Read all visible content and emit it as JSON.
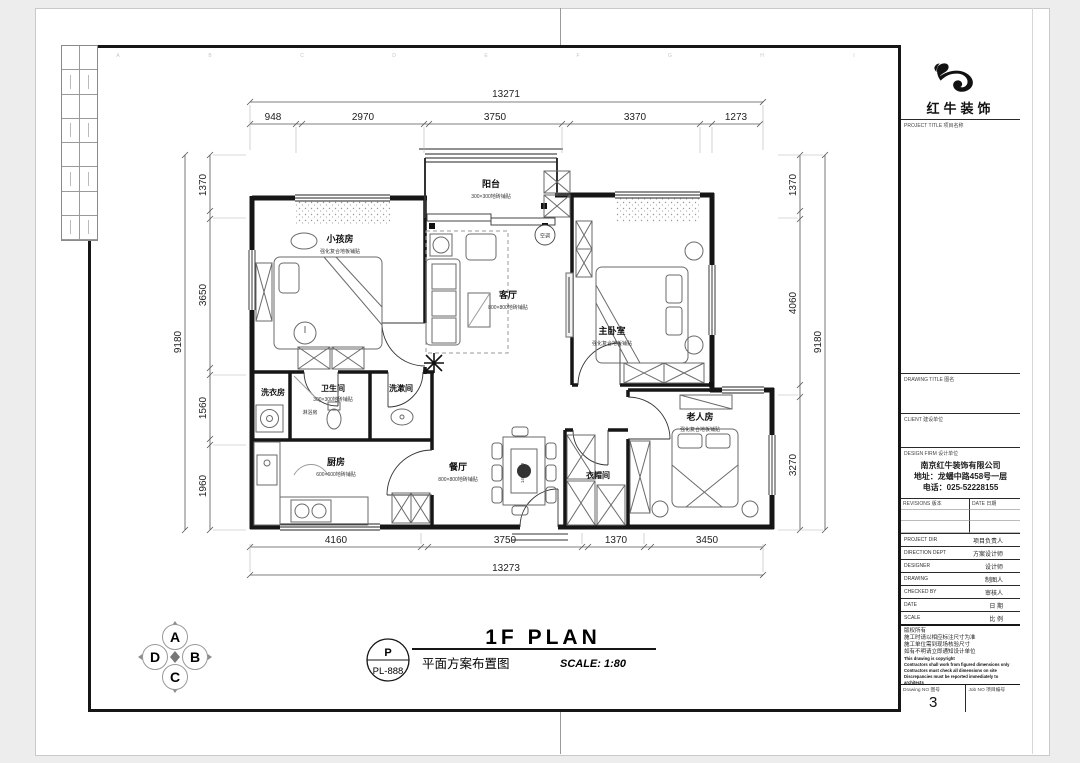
{
  "frame": {
    "grid_letters": [
      "A",
      "B",
      "C",
      "D",
      "E",
      "F",
      "G",
      "H",
      "I"
    ]
  },
  "logo": {
    "company": "红牛装饰",
    "project_title_label": "PROJECT TITLE 项目名称"
  },
  "titleblock": {
    "drawing_title": "DRAWING TITLE 图名",
    "client": "CLIENT 建设单位",
    "design_firm": "DESIGN FIRM 设计单位",
    "firm_name": "南京红牛装饰有限公司",
    "firm_address": "地址：龙蟠中路458号一层",
    "firm_phone": "电话：025-52228155",
    "revisions": "REVISIONS 版本",
    "rev_date": "DATE 日期",
    "rows": [
      {
        "en": "PROJECT DIR",
        "cn": "项目负责人"
      },
      {
        "en": "DIRECTION DEPT",
        "cn": "方案设计师"
      },
      {
        "en": "DESIGNER",
        "cn": "设计师"
      },
      {
        "en": "DRAWING",
        "cn": "制图人"
      },
      {
        "en": "CHECKED BY",
        "cn": "审核人"
      },
      {
        "en": "DATE",
        "cn": "日 期"
      },
      {
        "en": "SCALE",
        "cn": "比 例"
      }
    ],
    "notes": [
      "版权所有",
      "施工时请以相应标注尺寸为准",
      "施工单位需到现场核验尺寸",
      "如有不明请立即通知设计单位",
      "This drawing is copyright",
      "Contractors shall work from figured dimensions only",
      "Contractors must check all dimensions on site",
      "Discrepancies must be reported immediately to architects"
    ],
    "drawing_no_label": "Drawing NO 图号",
    "drawing_no": "3",
    "job_no_label": "Job NO 项目编号"
  },
  "plan": {
    "rooms": {
      "balcony": {
        "name": "阳台",
        "note": "300×300地砖铺贴"
      },
      "kids": {
        "name": "小孩房",
        "note": "强化复合地板铺贴"
      },
      "living": {
        "name": "客厅",
        "note": "800×800地砖铺贴"
      },
      "master": {
        "name": "主卧室",
        "note": "强化复合地板铺贴"
      },
      "laundry": {
        "name": "洗衣房"
      },
      "bath": {
        "name": "卫生间",
        "note": "300×300地砖铺贴"
      },
      "wash": {
        "name": "洗漱间"
      },
      "kitchen": {
        "name": "厨房",
        "note": "600×600地砖铺贴"
      },
      "dining": {
        "name": "餐厅",
        "note": "800×800地砖铺贴"
      },
      "cloak": {
        "name": "衣帽间"
      },
      "elder": {
        "name": "老人房",
        "note": "强化复合地板铺贴"
      }
    },
    "extra": {
      "ac": "空调",
      "shower": "淋浴房",
      "table": "1400×800"
    },
    "dims": {
      "top": {
        "total": "13271",
        "s": [
          "948",
          "2970",
          "3750",
          "3370",
          "1273"
        ]
      },
      "bottom": {
        "total": "13273",
        "s": [
          "4160",
          "3750",
          "1370",
          "3450"
        ]
      },
      "left": {
        "total": "9180",
        "s": [
          "1370",
          "3650",
          "1560",
          "1960"
        ]
      },
      "right": {
        "total": "9180",
        "s": [
          "1370",
          "4060",
          "3270"
        ]
      }
    }
  },
  "footer": {
    "badge_letter": "P",
    "badge_code": "PL-888",
    "title_cn": "平面方案布置图",
    "title_en": "1F PLAN",
    "scale": "SCALE: 1:80"
  },
  "compass": {
    "n": "A",
    "e": "B",
    "s": "C",
    "w": "D"
  }
}
